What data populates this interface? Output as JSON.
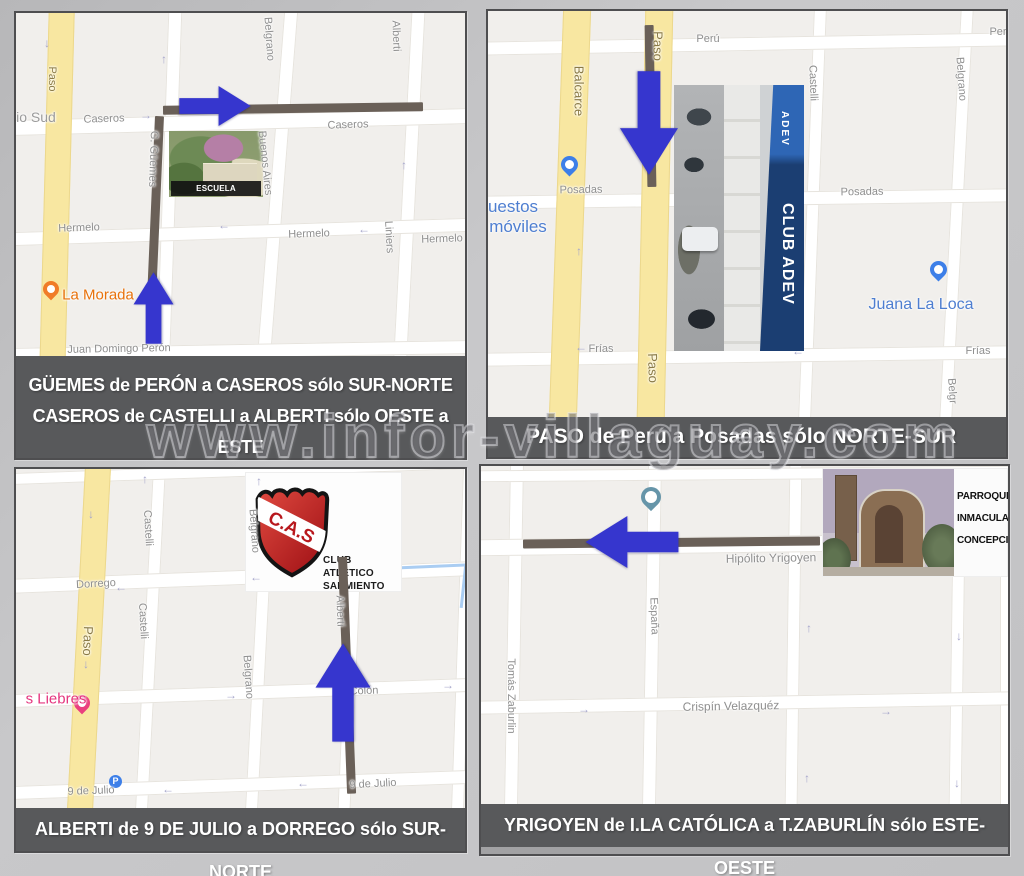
{
  "watermark": {
    "text": "www.infor-villaguay.com"
  },
  "theme": {
    "map_bg": "#f1efec",
    "street": "#ffffff",
    "road_yellow": "#f8e7a1",
    "route_dark": "#6a6058",
    "arrow_blue": "#3636ce",
    "caption_bg": "#58595b",
    "caption_text": "#ffffff",
    "label_gray": "#8f8f8f",
    "road_label": "#8a7a45",
    "poi_blue": "#4e7ed0",
    "poi_orange": "#e8710a",
    "poi_pink": "#e5347e",
    "pin_blue": "#3d7fe8",
    "pin_teal": "#6695a9",
    "pin_pink": "#ea3f7f",
    "pin_orange": "#f07c28",
    "oneway": "#a6a6cb",
    "water": "#aacdf2"
  },
  "panels": [
    {
      "name": "guemes-caseros",
      "caption": [
        "GÜEMES  de PERÓN a CASEROS sólo SUR-NORTE",
        "CASEROS de CASTELLI a ALBERTI sólo OESTE a ESTE"
      ],
      "photo": {
        "title": "ESCUELA PIEDRABUENA"
      },
      "labels": [
        {
          "t": "Paso",
          "x": 36,
          "y": 66,
          "r": 90,
          "c": "road"
        },
        {
          "t": "io Sud",
          "x": 20,
          "y": 104,
          "c": "area",
          "fs": 14
        },
        {
          "t": "Caseros",
          "x": 88,
          "y": 106,
          "r": -2
        },
        {
          "t": "Caseros",
          "x": 332,
          "y": 112,
          "r": -2
        },
        {
          "t": "Belgrano",
          "x": 253,
          "y": 26,
          "r": 86
        },
        {
          "t": "Alberti",
          "x": 380,
          "y": 23,
          "r": 88
        },
        {
          "t": "G. Güemes",
          "x": 137,
          "y": 146,
          "r": 92
        },
        {
          "t": "Buenos Aires",
          "x": 249,
          "y": 150,
          "r": 84
        },
        {
          "t": "Hermelo",
          "x": 63,
          "y": 215,
          "r": -2
        },
        {
          "t": "Hermelo",
          "x": 293,
          "y": 221,
          "r": -2
        },
        {
          "t": "Hermelo",
          "x": 426,
          "y": 226,
          "r": -2
        },
        {
          "t": "Liniers",
          "x": 373,
          "y": 224,
          "r": 87
        },
        {
          "t": "Juan Domingo Perón",
          "x": 103,
          "y": 336,
          "r": -1
        },
        {
          "t": "La Morada",
          "x": 82,
          "y": 282,
          "c": "orange",
          "fs": 15
        },
        {
          "t": "↓",
          "x": 31,
          "y": 30,
          "c": "ow"
        },
        {
          "t": "↑",
          "x": 148,
          "y": 46,
          "c": "ow"
        },
        {
          "t": "→",
          "x": 130,
          "y": 102,
          "c": "ow"
        },
        {
          "t": "←",
          "x": 208,
          "y": 212,
          "c": "ow"
        },
        {
          "t": "←",
          "x": 348,
          "y": 216,
          "c": "ow"
        },
        {
          "t": "↑",
          "x": 388,
          "y": 152,
          "c": "ow"
        }
      ]
    },
    {
      "name": "paso",
      "caption": [
        "PASO de Perú a Posadas sólo NORTE-SUR"
      ],
      "photo": {
        "title": "CLUB ADEV",
        "small": "ADEV"
      },
      "labels": [
        {
          "t": "Perú",
          "x": 220,
          "y": 28
        },
        {
          "t": "Per",
          "x": 510,
          "y": 21
        },
        {
          "t": "Balcarce",
          "x": 91,
          "y": 80,
          "r": 90,
          "c": "road",
          "fs": 13
        },
        {
          "t": "Paso",
          "x": 170,
          "y": 35,
          "r": 90,
          "c": "road",
          "fs": 13
        },
        {
          "t": "Paso",
          "x": 165,
          "y": 357,
          "r": 88,
          "c": "road",
          "fs": 13
        },
        {
          "t": "Castelli",
          "x": 325,
          "y": 72,
          "r": 88
        },
        {
          "t": "Belgrano",
          "x": 473,
          "y": 68,
          "r": 86
        },
        {
          "t": "Belgr",
          "x": 464,
          "y": 380,
          "r": 86
        },
        {
          "t": "Posadas",
          "x": 93,
          "y": 179,
          "r": -1
        },
        {
          "t": "Posadas",
          "x": 374,
          "y": 181,
          "r": -1
        },
        {
          "t": "Frías",
          "x": 113,
          "y": 338
        },
        {
          "t": "Frías",
          "x": 490,
          "y": 340
        },
        {
          "t": "uestos",
          "x": 25,
          "y": 196,
          "c": "blue",
          "fs": 17
        },
        {
          "t": "móviles",
          "x": 30,
          "y": 216,
          "c": "blue",
          "fs": 17
        },
        {
          "t": "Juana La Loca",
          "x": 433,
          "y": 294,
          "c": "blue",
          "fs": 16
        },
        {
          "t": "↑",
          "x": 91,
          "y": 240,
          "c": "ow"
        },
        {
          "t": "←",
          "x": 93,
          "y": 336,
          "c": "ow"
        },
        {
          "t": "←",
          "x": 310,
          "y": 340,
          "c": "ow"
        }
      ]
    },
    {
      "name": "alberti",
      "caption": [
        "ALBERTI de 9 DE JULIO a DORREGO sólo SUR-NORTE"
      ],
      "logo": {
        "initials": "C.A.S",
        "lines": [
          "CLUB",
          "ATLÉTICO",
          "SARMIENTO"
        ]
      },
      "parking_icon": "P",
      "labels": [
        {
          "t": "Paso",
          "x": 72,
          "y": 172,
          "r": 92,
          "c": "road",
          "fs": 13
        },
        {
          "t": "Castelli",
          "x": 132,
          "y": 59,
          "r": 87
        },
        {
          "t": "Castelli",
          "x": 127,
          "y": 152,
          "r": 87
        },
        {
          "t": "Belgrano",
          "x": 238,
          "y": 62,
          "r": 86
        },
        {
          "t": "Belgrano",
          "x": 232,
          "y": 208,
          "r": 86
        },
        {
          "t": "Alberti",
          "x": 324,
          "y": 142,
          "r": 88
        },
        {
          "t": "Dorrego",
          "x": 80,
          "y": 115,
          "r": -3
        },
        {
          "t": "Colón",
          "x": 348,
          "y": 222,
          "r": -2
        },
        {
          "t": "9 de Julio",
          "x": 75,
          "y": 322,
          "r": -2
        },
        {
          "t": "9 de Julio",
          "x": 357,
          "y": 315,
          "r": -3
        },
        {
          "t": "s Liebres",
          "x": 40,
          "y": 230,
          "c": "pink",
          "fs": 15
        },
        {
          "t": "←",
          "x": 105,
          "y": 118,
          "c": "ow"
        },
        {
          "t": "←",
          "x": 240,
          "y": 108,
          "c": "ow"
        },
        {
          "t": "→",
          "x": 215,
          "y": 226,
          "c": "ow"
        },
        {
          "t": "→",
          "x": 432,
          "y": 216,
          "c": "ow"
        },
        {
          "t": "←",
          "x": 152,
          "y": 320,
          "c": "ow"
        },
        {
          "t": "←",
          "x": 287,
          "y": 314,
          "c": "ow"
        },
        {
          "t": "↓",
          "x": 75,
          "y": 45,
          "c": "ow"
        },
        {
          "t": "↓",
          "x": 70,
          "y": 195,
          "c": "ow"
        },
        {
          "t": "↑",
          "x": 129,
          "y": 10,
          "c": "ow"
        },
        {
          "t": "↑",
          "x": 243,
          "y": 12,
          "c": "ow"
        }
      ]
    },
    {
      "name": "yrigoyen",
      "caption": [
        "YRIGOYEN de I.LA CATÓLICA a T.ZABURLÍN sólo ESTE-OESTE"
      ],
      "photo": {
        "lines": [
          "PARROQUIA",
          "INMACULADA",
          "CONCEPCIÓN"
        ]
      },
      "labels": [
        {
          "t": "Hipólito Yrigoyen",
          "x": 290,
          "y": 92,
          "r": -1,
          "fs": 12
        },
        {
          "t": "España",
          "x": 173,
          "y": 150,
          "r": 88
        },
        {
          "t": "Tomás Zaburlin",
          "x": 30,
          "y": 230,
          "r": 90
        },
        {
          "t": "Crispín Velazquéz",
          "x": 250,
          "y": 240,
          "r": -1,
          "fs": 12
        },
        {
          "t": "↑",
          "x": 328,
          "y": 162,
          "c": "ow"
        },
        {
          "t": "↓",
          "x": 478,
          "y": 170,
          "c": "ow"
        },
        {
          "t": "↑",
          "x": 326,
          "y": 312,
          "c": "ow"
        },
        {
          "t": "↓",
          "x": 476,
          "y": 317,
          "c": "ow"
        },
        {
          "t": "→",
          "x": 103,
          "y": 243,
          "c": "ow"
        },
        {
          "t": "→",
          "x": 405,
          "y": 245,
          "c": "ow"
        }
      ]
    }
  ]
}
